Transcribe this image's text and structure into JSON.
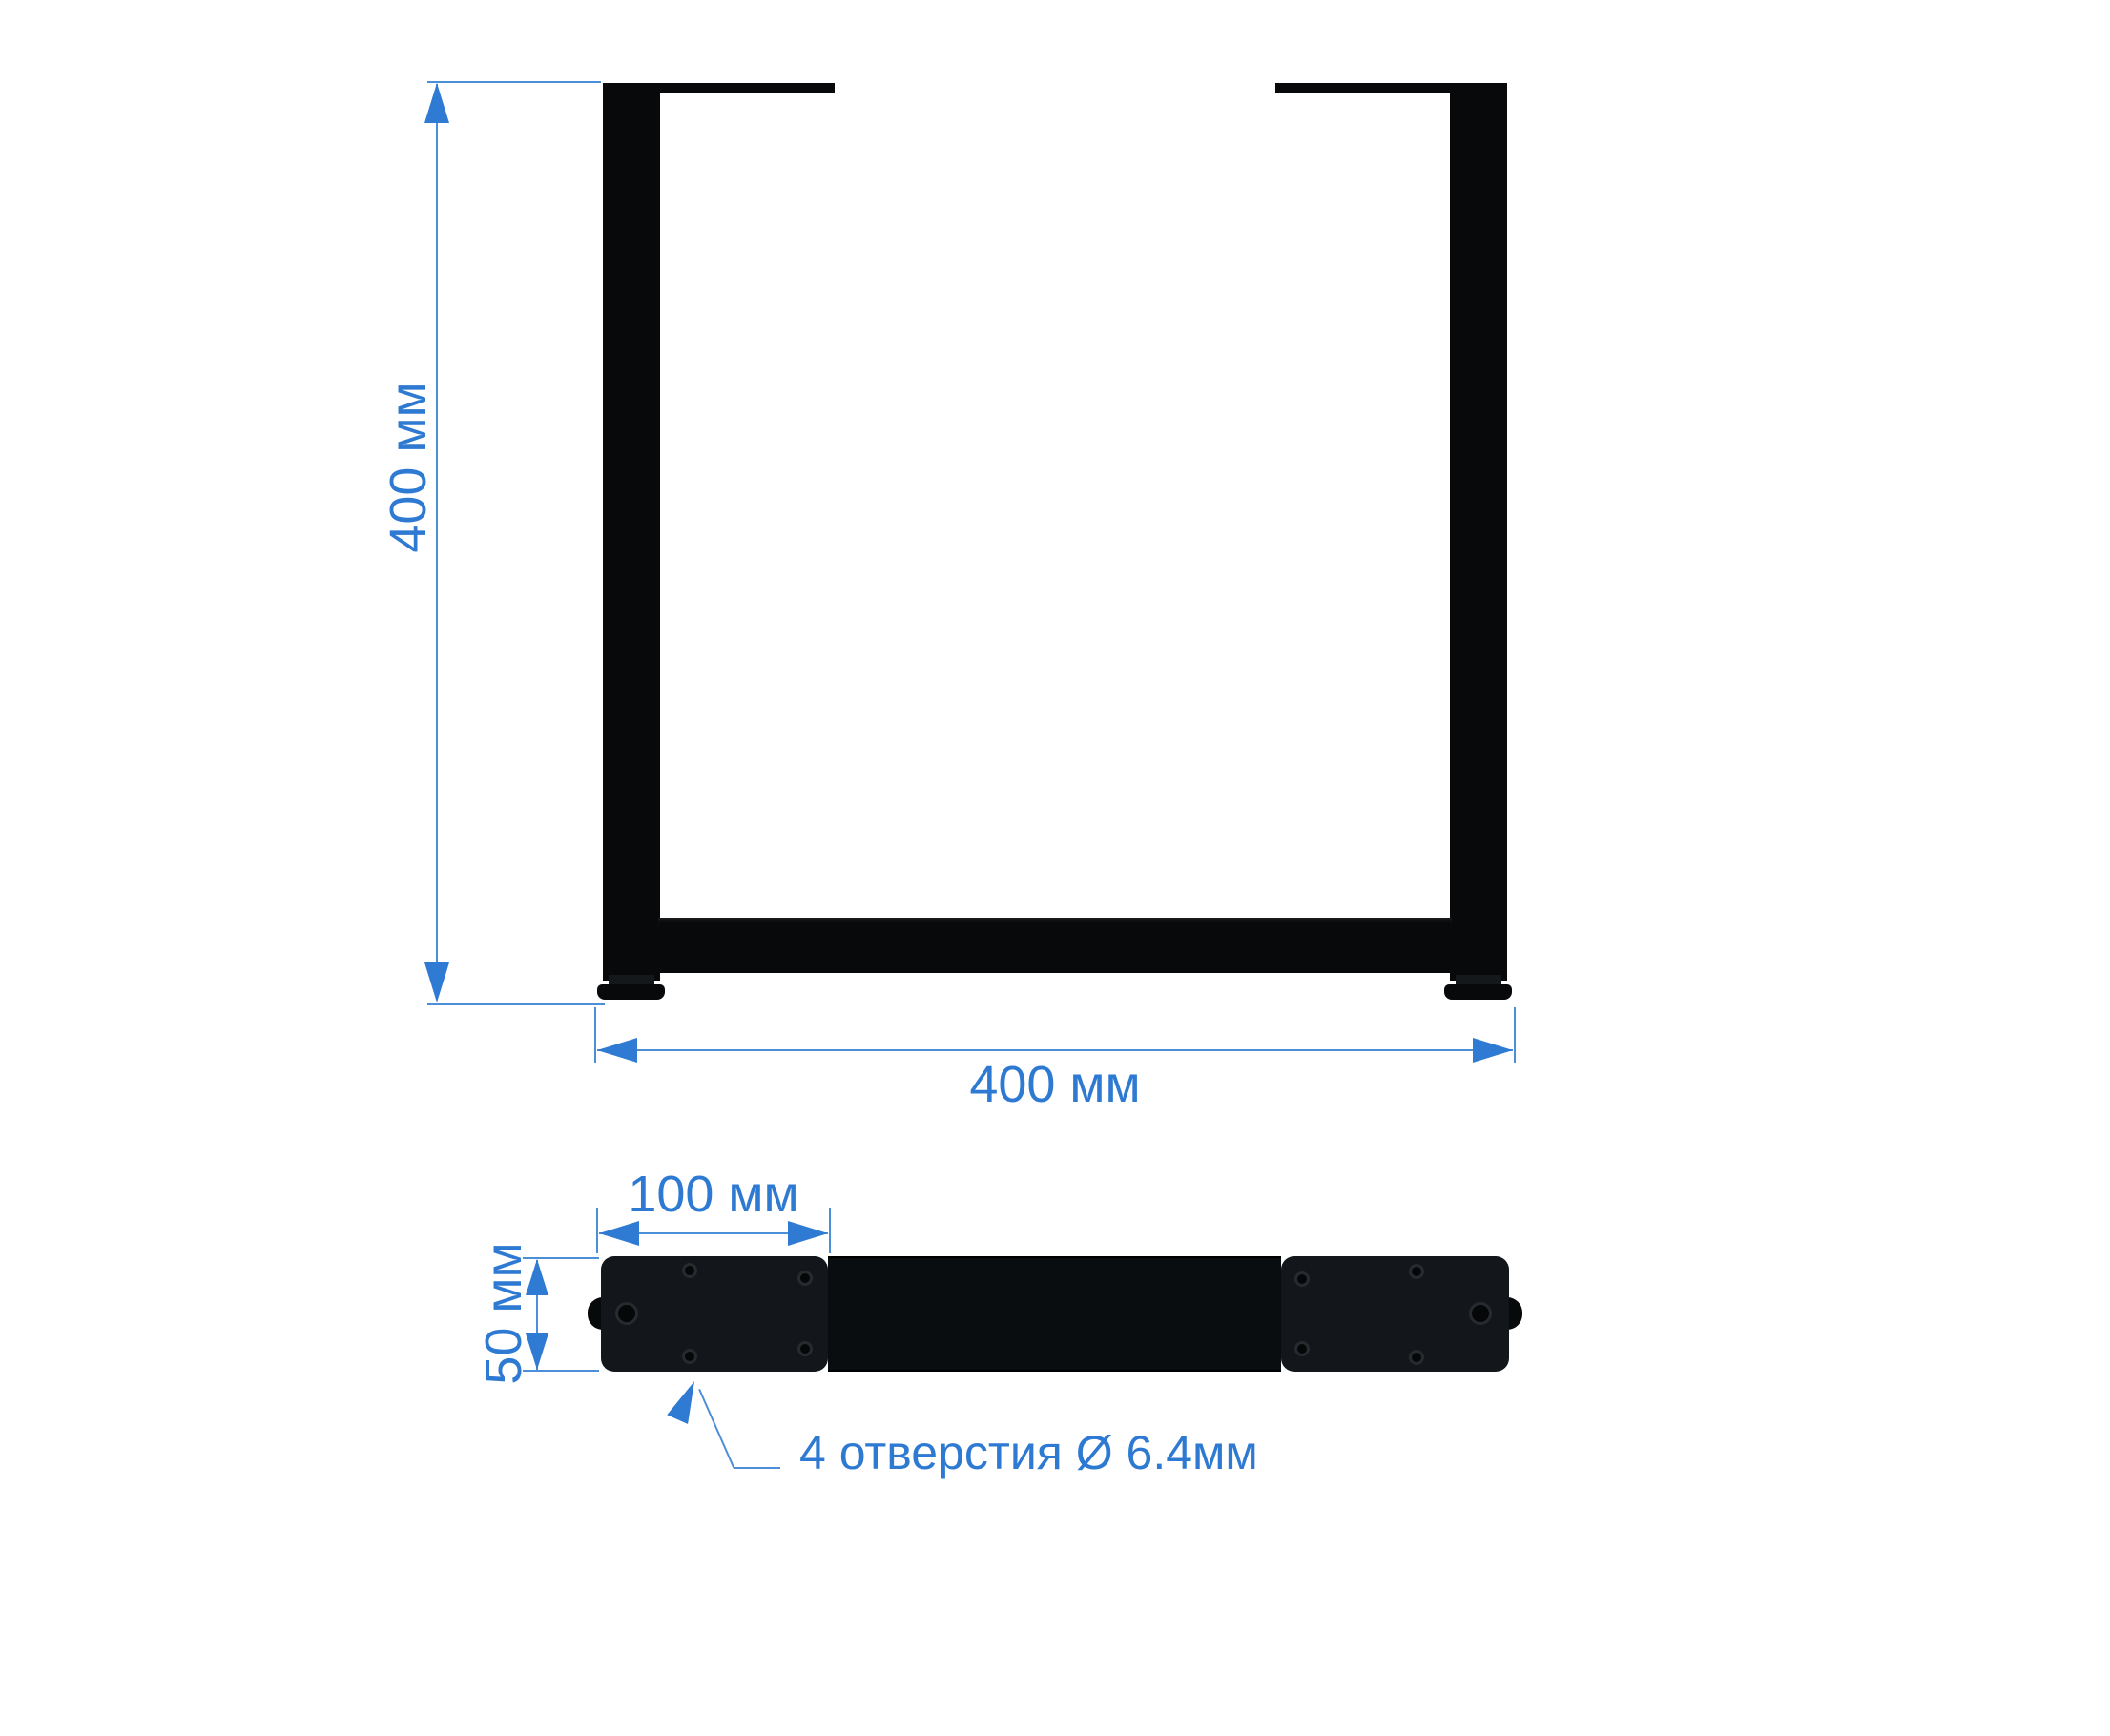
{
  "drawing": {
    "type": "technical-dimension-drawing",
    "part": "U-shaped table leg frame, front view and bottom (plate) view",
    "dimensions": {
      "height_label": "400 мм",
      "width_label": "400 мм",
      "plate_length_label": "100 мм",
      "bar_width_label": "50 мм"
    },
    "annotations": {
      "holes_note": "4 отверстия Ø 6.4мм"
    },
    "colors": {
      "dim-text": "#2e7ad2",
      "dim-line": "#4d8ed8",
      "arrow": "#2f7bd3",
      "part-black": "#07090b",
      "plate-dark": "#13161a"
    }
  }
}
